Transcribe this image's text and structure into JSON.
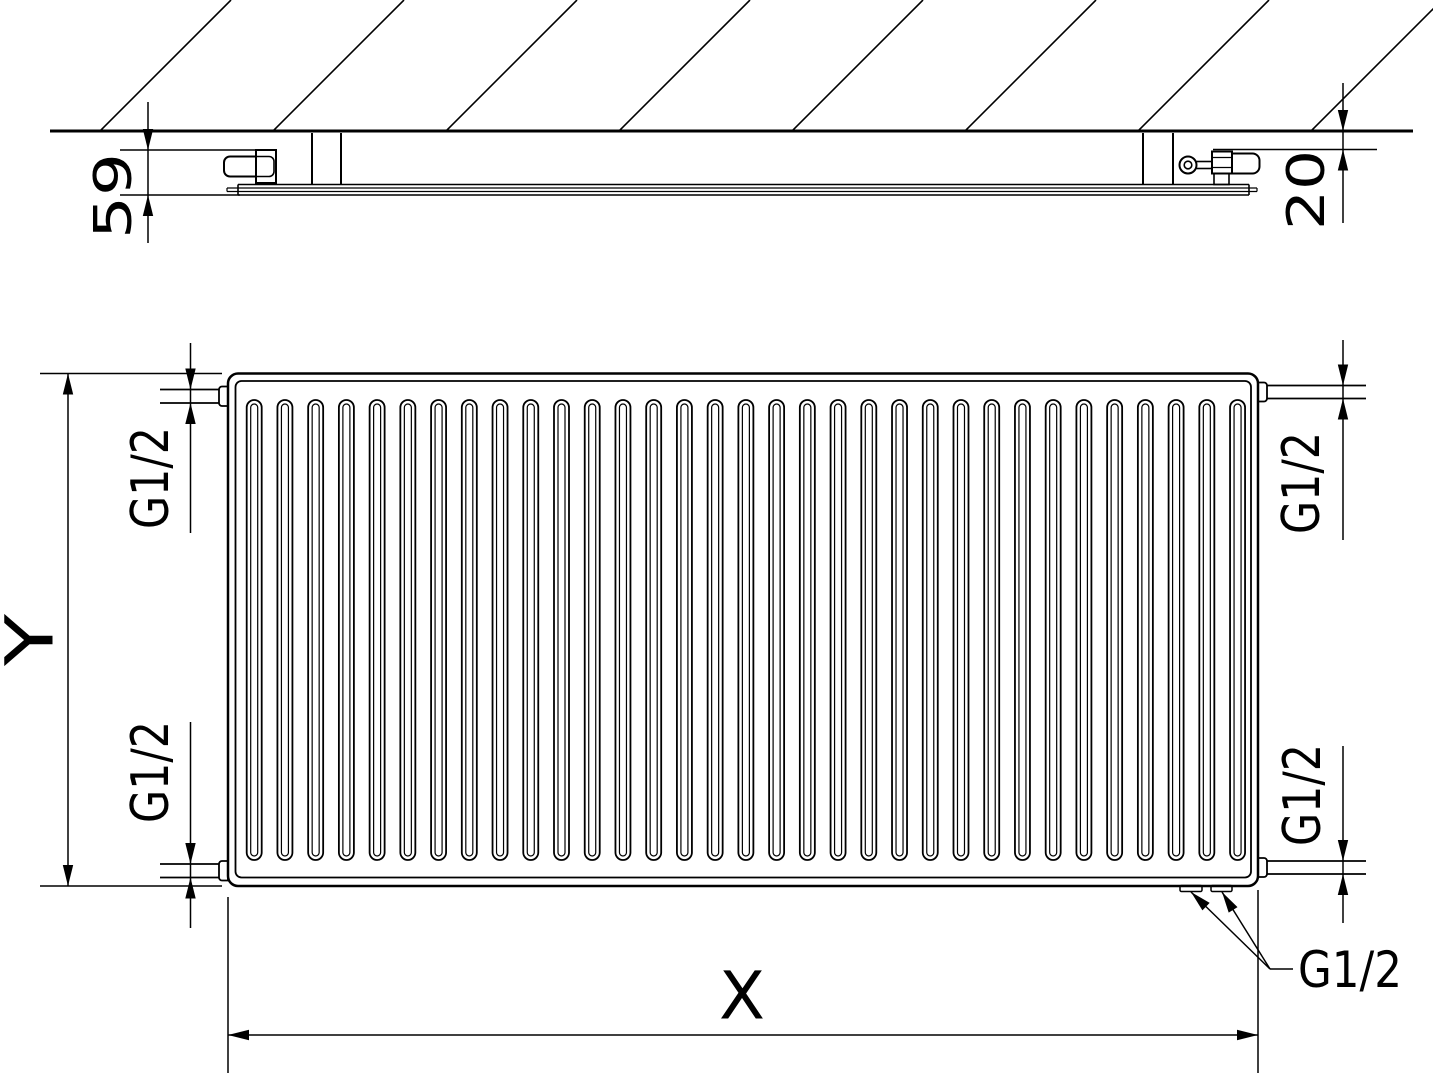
{
  "title": "panel-radiator-technical-drawing",
  "side_view": {
    "depth_dim": "59",
    "wall_gap_dim": "20"
  },
  "front_view": {
    "height_dim": "Y",
    "width_dim": "X",
    "thread_top_left": "G1/2",
    "thread_bottom_left": "G1/2",
    "thread_top_right": "G1/2",
    "thread_bottom_right": "G1/2",
    "thread_bottom_tappings": "G1/2"
  },
  "drawing": {
    "line_color": "#000000",
    "background_color": "#ffffff",
    "channel_count": 33,
    "channel_pitch": 30.73,
    "channel_width": 15,
    "channel_top": 400,
    "channel_bottom": 860,
    "hatch_count": 8,
    "hatch_spacing": 173,
    "wall_y": 131,
    "body": {
      "x": 228,
      "y": 373.5,
      "w": 1030,
      "h": 512.5
    }
  }
}
